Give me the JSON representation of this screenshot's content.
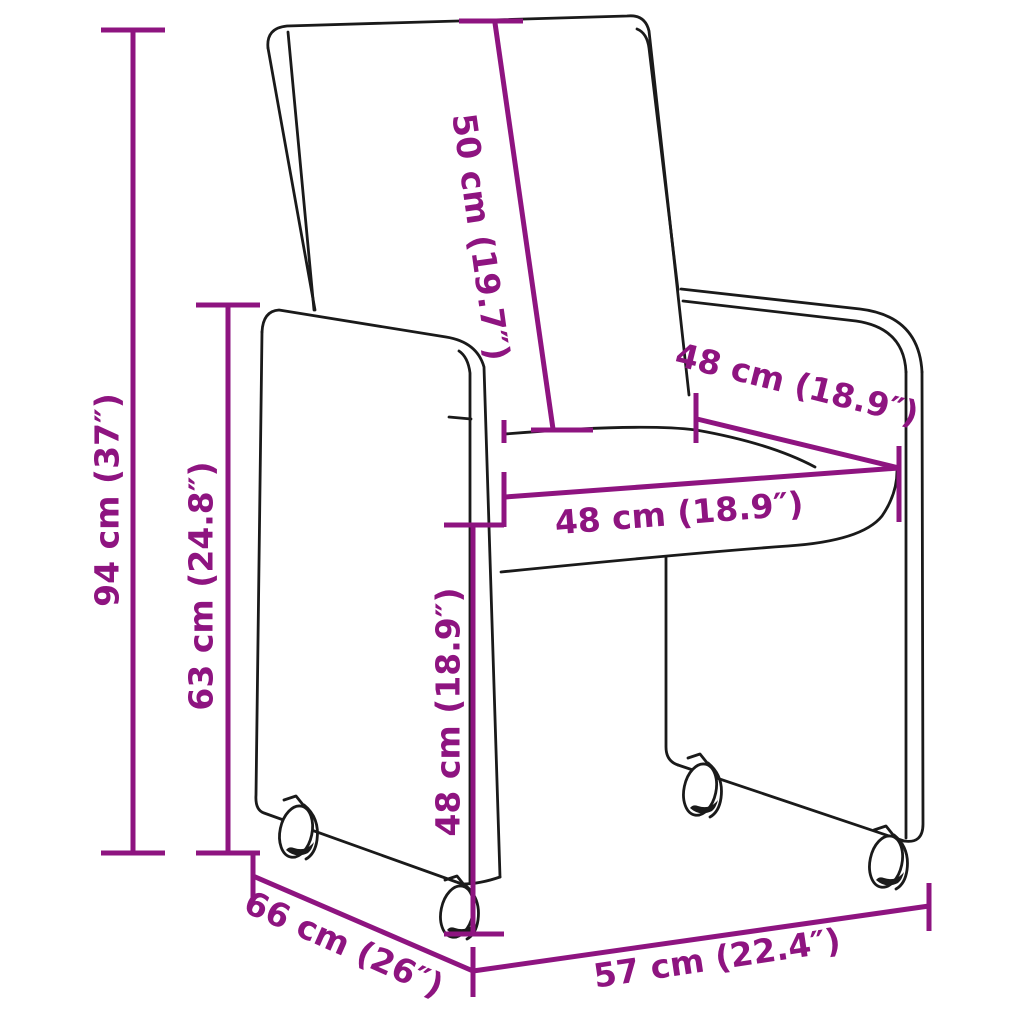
{
  "diagram": {
    "subject": "upholstered dining chair with casters",
    "colors": {
      "accent": "#8E1480",
      "line": "#1a1a1a",
      "bg": "#ffffff"
    },
    "unit_format": "cm (inches)",
    "measurements": [
      {
        "id": "overall-height",
        "label": "94 cm (37″)",
        "cm": 94,
        "inch": 37
      },
      {
        "id": "side-panel-height",
        "label": "63 cm (24.8″)",
        "cm": 63,
        "inch": 24.8
      },
      {
        "id": "backrest-length",
        "label": "50 cm (19.7″)",
        "cm": 50,
        "inch": 19.7
      },
      {
        "id": "back-width",
        "label": "48 cm (18.9″)",
        "cm": 48,
        "inch": 18.9
      },
      {
        "id": "seat-width",
        "label": "48 cm (18.9″)",
        "cm": 48,
        "inch": 18.9
      },
      {
        "id": "seat-height",
        "label": "48 cm (18.9″)",
        "cm": 48,
        "inch": 18.9
      },
      {
        "id": "depth",
        "label": "66 cm (26″)",
        "cm": 66,
        "inch": 26
      },
      {
        "id": "width",
        "label": "57 cm (22.4″)",
        "cm": 57,
        "inch": 22.4
      }
    ]
  }
}
